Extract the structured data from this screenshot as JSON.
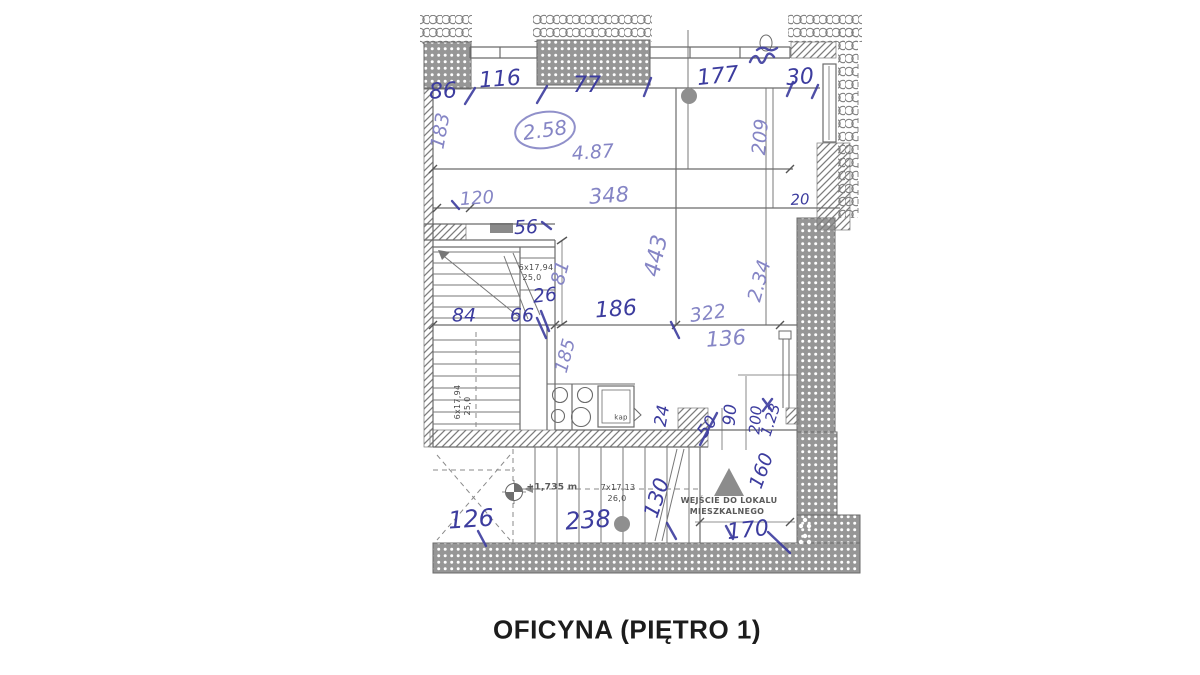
{
  "title": "OFICYNA (PIĘTRO 1)",
  "colors": {
    "ink_dark": "#3c3c9e",
    "ink_light": "#8585c5",
    "print_gray": "#4a4a4a",
    "wall_gray": "#969696",
    "line_gray": "#6b6b6b",
    "background": "#ffffff"
  },
  "plan": {
    "room_number": "2.58",
    "annotations": [
      {
        "name": "dim-86",
        "text": "86",
        "x": 443,
        "y": 92,
        "rot": -3,
        "size": 22,
        "cls": "hand"
      },
      {
        "name": "dim-116",
        "text": "116",
        "x": 500,
        "y": 80,
        "rot": -4,
        "size": 22,
        "cls": "hand"
      },
      {
        "name": "dim-77",
        "text": "77",
        "x": 587,
        "y": 86,
        "rot": 0,
        "size": 22,
        "cls": "hand"
      },
      {
        "name": "dim-177",
        "text": "177",
        "x": 718,
        "y": 77,
        "rot": -6,
        "size": 22,
        "cls": "hand"
      },
      {
        "name": "dim-30",
        "text": "30",
        "x": 800,
        "y": 78,
        "rot": -4,
        "size": 22,
        "cls": "hand"
      },
      {
        "name": "dim-20",
        "text": "20",
        "x": 800,
        "y": 200,
        "rot": -3,
        "size": 15,
        "cls": "hand"
      },
      {
        "name": "dim-56",
        "text": "56",
        "x": 526,
        "y": 228,
        "rot": -3,
        "size": 19,
        "cls": "hand"
      },
      {
        "name": "dim-26",
        "text": "26",
        "x": 545,
        "y": 296,
        "rot": -6,
        "size": 19,
        "cls": "hand"
      },
      {
        "name": "dim-84",
        "text": "84",
        "x": 464,
        "y": 316,
        "rot": 0,
        "size": 19,
        "cls": "hand"
      },
      {
        "name": "dim-66",
        "text": "66",
        "x": 522,
        "y": 316,
        "rot": 0,
        "size": 19,
        "cls": "hand"
      },
      {
        "name": "dim-186",
        "text": "186",
        "x": 616,
        "y": 310,
        "rot": -4,
        "size": 22,
        "cls": "hand"
      },
      {
        "name": "dim-24",
        "text": "24",
        "x": 663,
        "y": 416,
        "rot": -80,
        "size": 17,
        "cls": "hand"
      },
      {
        "name": "dim-50",
        "text": "50",
        "x": 708,
        "y": 427,
        "rot": -55,
        "size": 17,
        "cls": "hand"
      },
      {
        "name": "dim-90",
        "text": "90",
        "x": 731,
        "y": 415,
        "rot": -85,
        "size": 17,
        "cls": "hand"
      },
      {
        "name": "dim-200",
        "text": "200",
        "x": 756,
        "y": 420,
        "rot": -85,
        "size": 15,
        "cls": "hand"
      },
      {
        "name": "dim-1-23",
        "text": "1.23",
        "x": 771,
        "y": 420,
        "rot": -72,
        "size": 15,
        "cls": "hand"
      },
      {
        "name": "dim-160",
        "text": "160",
        "x": 762,
        "y": 471,
        "rot": -70,
        "size": 19,
        "cls": "hand"
      },
      {
        "name": "dim-130",
        "text": "130",
        "x": 657,
        "y": 498,
        "rot": -72,
        "size": 21,
        "cls": "hand"
      },
      {
        "name": "dim-126",
        "text": "126",
        "x": 471,
        "y": 519,
        "rot": -4,
        "size": 24,
        "cls": "hand"
      },
      {
        "name": "dim-238",
        "text": "238",
        "x": 588,
        "y": 520,
        "rot": -4,
        "size": 24,
        "cls": "hand"
      },
      {
        "name": "dim-170",
        "text": "170",
        "x": 748,
        "y": 531,
        "rot": -6,
        "size": 22,
        "cls": "hand"
      },
      {
        "name": "room-number",
        "text": "2.58",
        "x": 545,
        "y": 130,
        "rot": -8,
        "size": 20,
        "cls": "hand lt"
      },
      {
        "name": "dim-4-87",
        "text": "4.87",
        "x": 593,
        "y": 153,
        "rot": -4,
        "size": 19,
        "cls": "hand lt"
      },
      {
        "name": "dim-183",
        "text": "183",
        "x": 441,
        "y": 131,
        "rot": -80,
        "size": 19,
        "cls": "hand lt"
      },
      {
        "name": "dim-209",
        "text": "209",
        "x": 761,
        "y": 137,
        "rot": -85,
        "size": 19,
        "cls": "hand lt"
      },
      {
        "name": "dim-120",
        "text": "120",
        "x": 477,
        "y": 199,
        "rot": -4,
        "size": 18,
        "cls": "hand lt"
      },
      {
        "name": "dim-348",
        "text": "348",
        "x": 609,
        "y": 196,
        "rot": -4,
        "size": 21,
        "cls": "hand lt"
      },
      {
        "name": "dim-81",
        "text": "81",
        "x": 561,
        "y": 273,
        "rot": -75,
        "size": 19,
        "cls": "hand lt"
      },
      {
        "name": "dim-443",
        "text": "443",
        "x": 657,
        "y": 256,
        "rot": -78,
        "size": 22,
        "cls": "hand lt"
      },
      {
        "name": "dim-2-34",
        "text": "2.34",
        "x": 760,
        "y": 281,
        "rot": -75,
        "size": 19,
        "cls": "hand lt"
      },
      {
        "name": "dim-322",
        "text": "322",
        "x": 708,
        "y": 314,
        "rot": -8,
        "size": 19,
        "cls": "hand lt"
      },
      {
        "name": "dim-136",
        "text": "136",
        "x": 726,
        "y": 339,
        "rot": -4,
        "size": 21,
        "cls": "hand lt"
      },
      {
        "name": "dim-185",
        "text": "185",
        "x": 566,
        "y": 356,
        "rot": -75,
        "size": 18,
        "cls": "hand lt"
      },
      {
        "name": "stair-spec-upper",
        "text": "6x17,94",
        "x": 536,
        "y": 268,
        "rot": 0,
        "size": 8,
        "cls": "print"
      },
      {
        "name": "stair-width-upper",
        "text": "25,0",
        "x": 532,
        "y": 278,
        "rot": 0,
        "size": 8,
        "cls": "print"
      },
      {
        "name": "stair-spec-left",
        "text": "6x17,94",
        "x": 458,
        "y": 402,
        "rot": -90,
        "size": 8,
        "cls": "print"
      },
      {
        "name": "stair-width-left",
        "text": "25,0",
        "x": 468,
        "y": 406,
        "rot": -90,
        "size": 8,
        "cls": "print"
      },
      {
        "name": "stair-spec-bottom",
        "text": "7x17,13",
        "x": 618,
        "y": 488,
        "rot": 0,
        "size": 8,
        "cls": "print"
      },
      {
        "name": "stair-width-bottom",
        "text": "26,0",
        "x": 617,
        "y": 499,
        "rot": 0,
        "size": 8,
        "cls": "print"
      },
      {
        "name": "level-label",
        "text": "+1,735 m",
        "x": 552,
        "y": 488,
        "rot": 0,
        "size": 9,
        "cls": "print pb"
      },
      {
        "name": "shower-label",
        "text": "kap",
        "x": 621,
        "y": 418,
        "rot": 0,
        "size": 7,
        "cls": "print"
      },
      {
        "name": "entrance-label-line1",
        "text": "WEJŚCIE DO LOKALU",
        "x": 729,
        "y": 501,
        "rot": 0,
        "size": 8,
        "cls": "print pb"
      },
      {
        "name": "entrance-label-line2",
        "text": "MIESZKALNEGO",
        "x": 727,
        "y": 512,
        "rot": 0,
        "size": 8,
        "cls": "print pb"
      }
    ]
  }
}
